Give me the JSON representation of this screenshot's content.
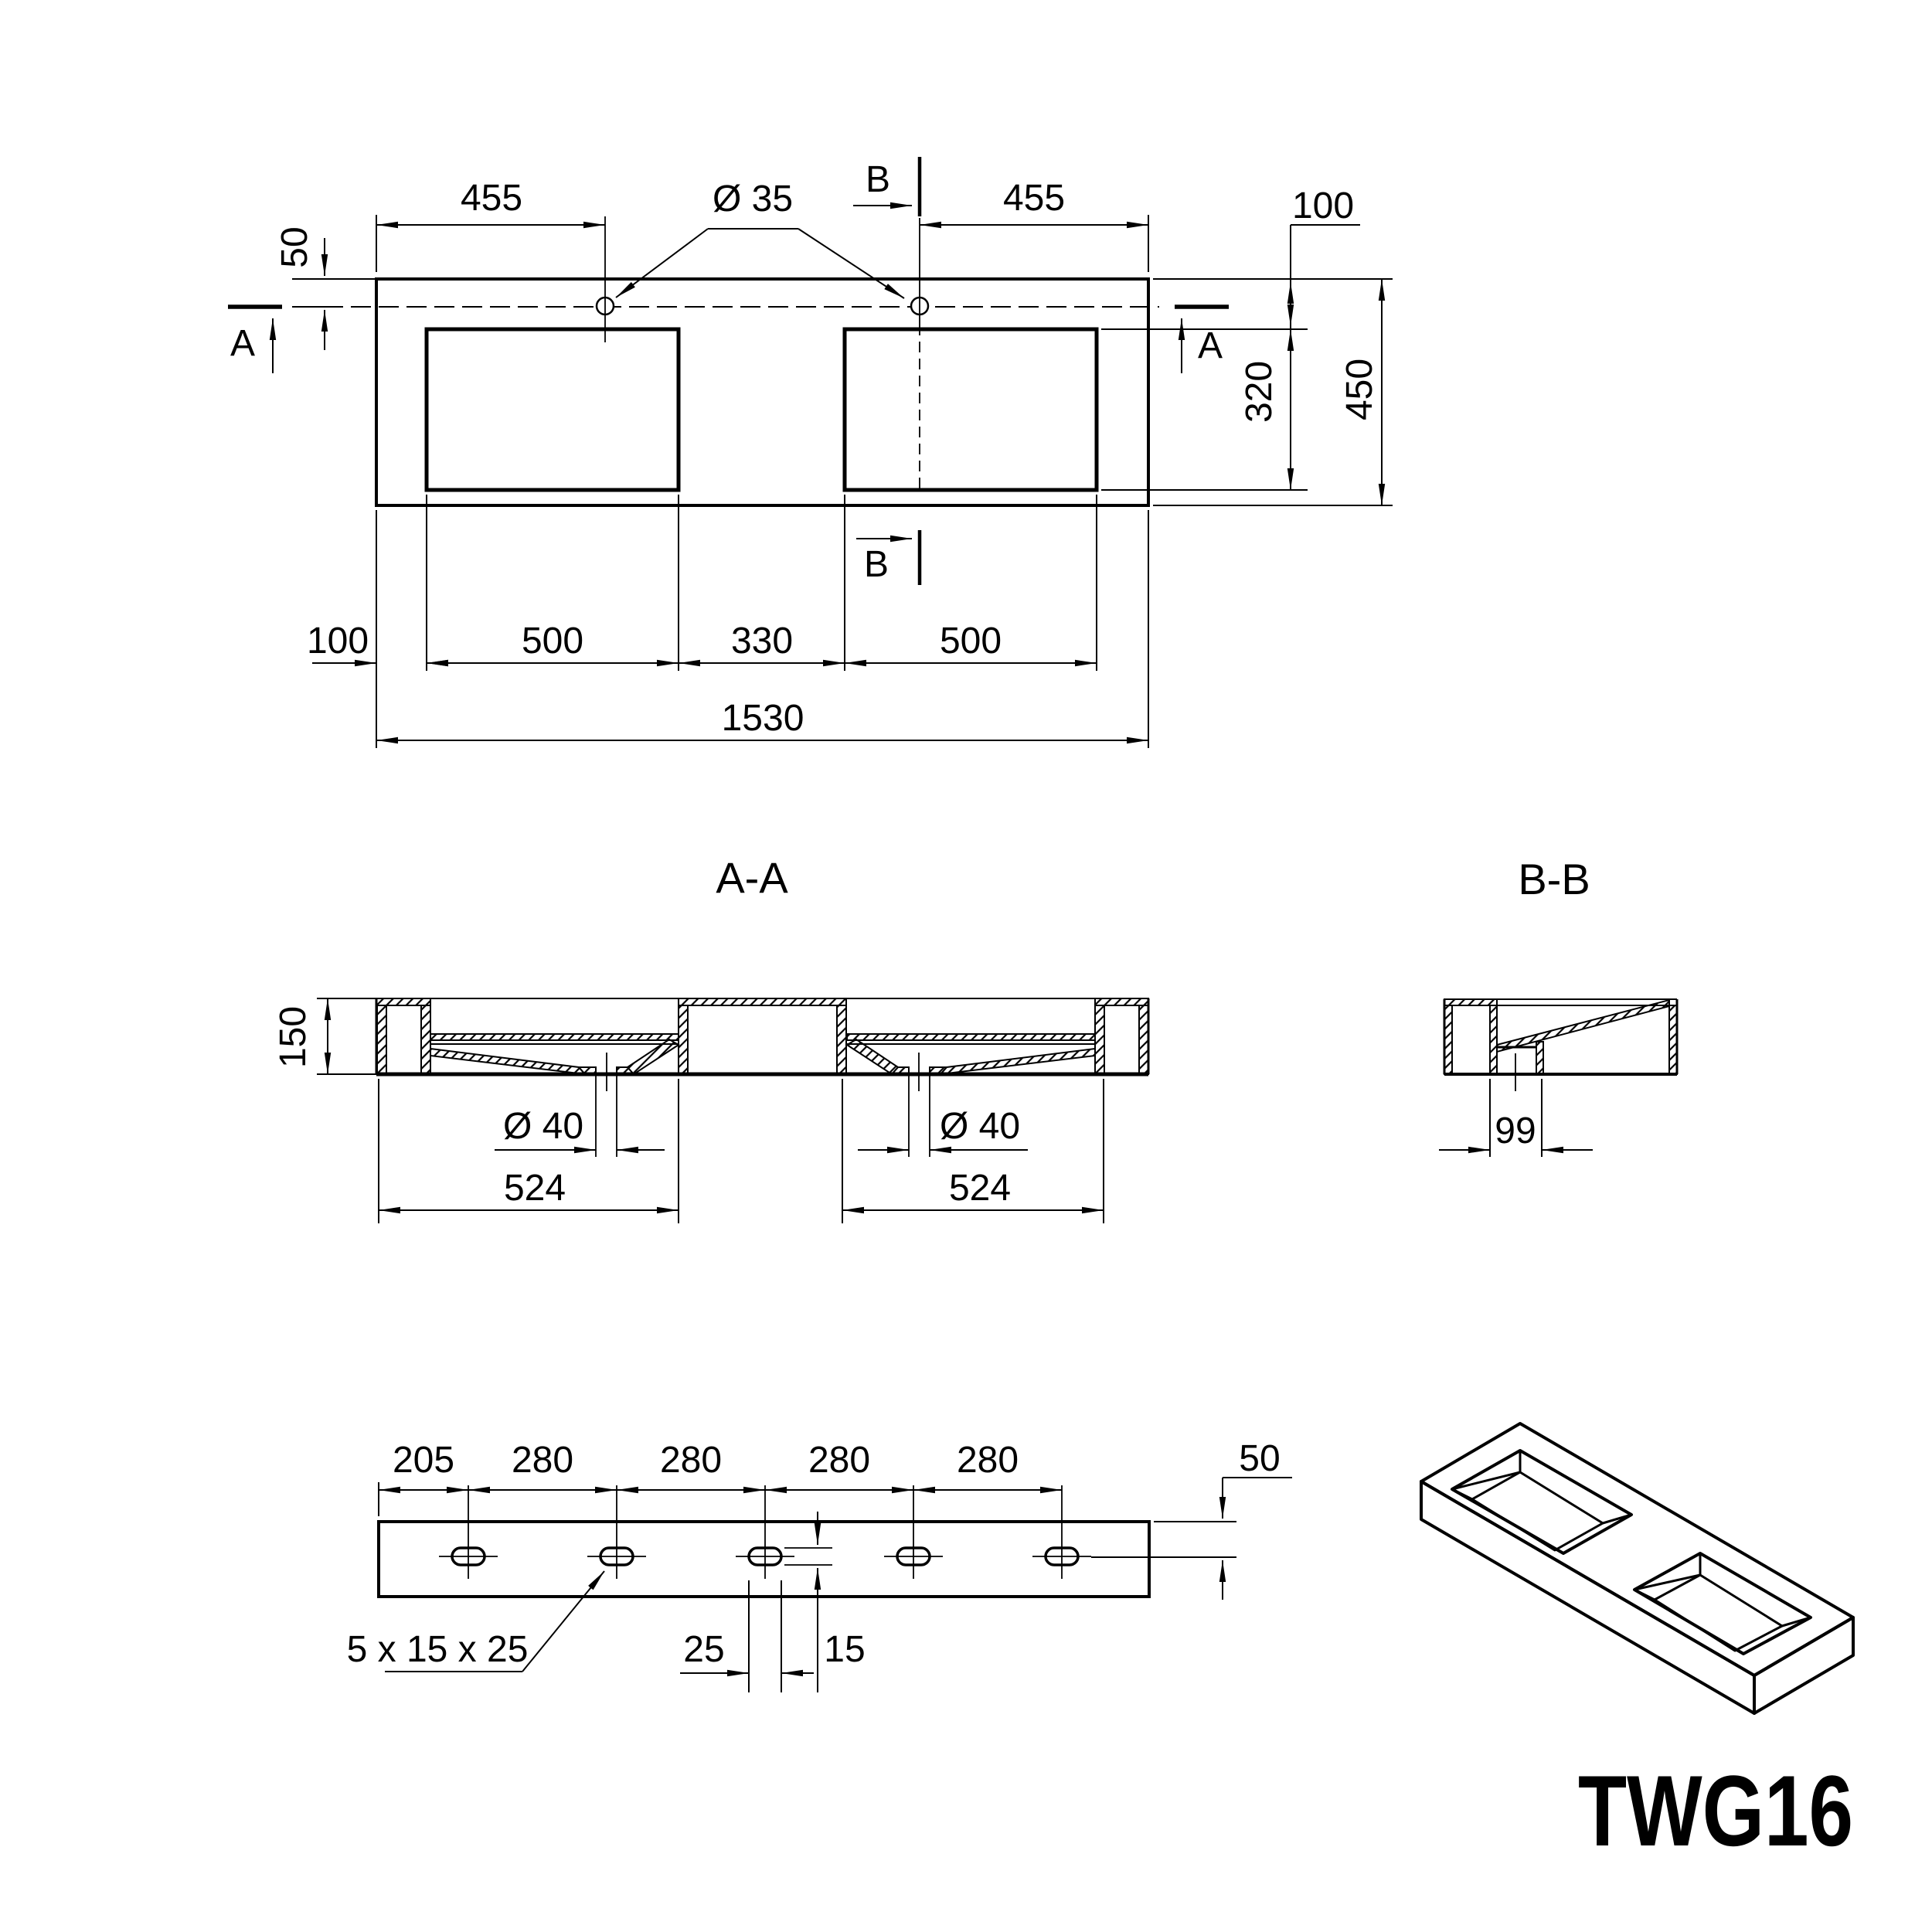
{
  "meta": {
    "drawing_type": "technical drawing, double washbasin",
    "line_color": "#000000",
    "background_color": "#ffffff",
    "product_code": "TWG16"
  },
  "top_view": {
    "dim_455_left": "455",
    "dia_35": "Ø 35",
    "section_b": "B",
    "dim_455_right": "455",
    "dim_100_right": "100",
    "dim_50_left": "50",
    "section_a": "A",
    "dim_320": "320",
    "dim_450": "450",
    "dim_100_bottom": "100",
    "dim_500_left": "500",
    "dim_330": "330",
    "dim_500_right": "500",
    "dim_1530": "1530"
  },
  "section_aa": {
    "title": "A-A",
    "dim_150": "150",
    "dia_40_left": "Ø 40",
    "dia_40_right": "Ø 40",
    "dim_524_left": "524",
    "dim_524_right": "524"
  },
  "section_bb": {
    "title": "B-B",
    "dim_99": "99"
  },
  "bottom_view": {
    "dim_205": "205",
    "dim_280_a": "280",
    "dim_280_b": "280",
    "dim_280_c": "280",
    "dim_280_d": "280",
    "dim_50_right": "50",
    "slot_spec": "5 x 15 x 25",
    "dim_25": "25",
    "dim_15": "15"
  },
  "iso_view": {
    "model_label": "TWG16"
  }
}
